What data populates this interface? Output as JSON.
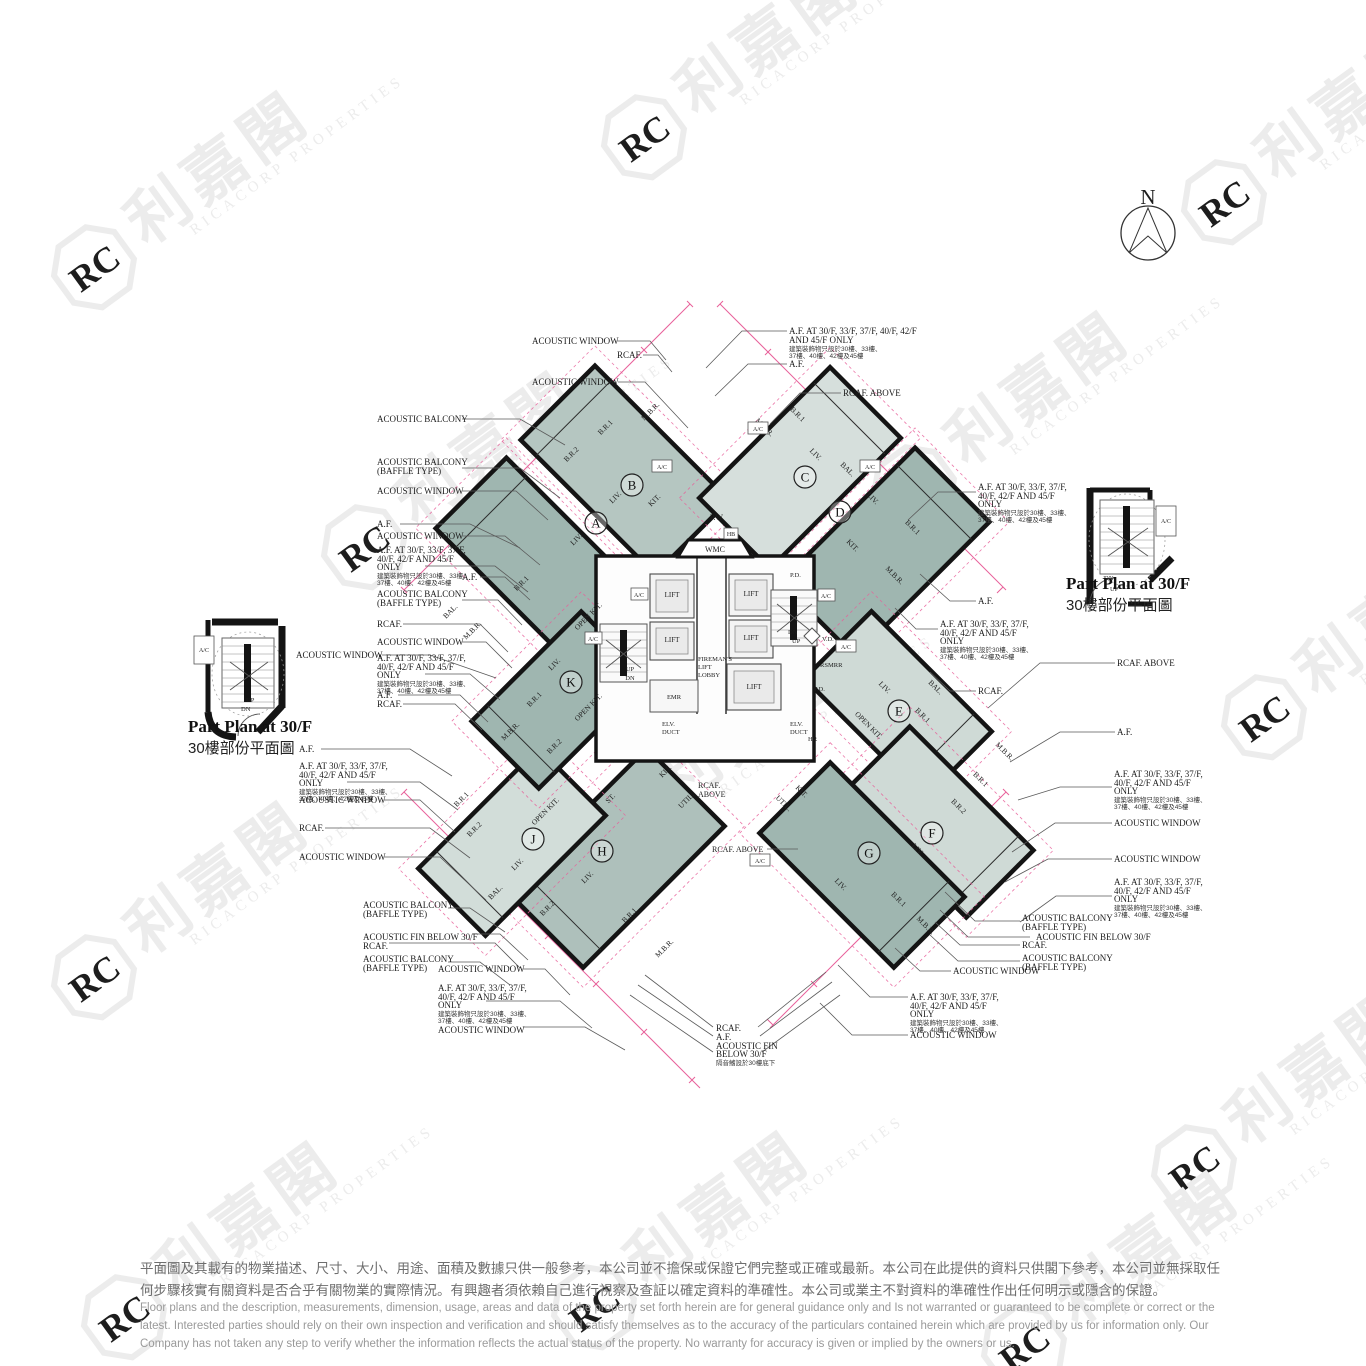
{
  "watermark": {
    "cn": "利嘉閣",
    "en": "RICACORP PROPERTIES",
    "monogram": "RC"
  },
  "north_label": "N",
  "inset": {
    "title": "Part Plan at 30/F",
    "subtitle": "30樓部份平面圖"
  },
  "labels": {
    "aw": "ACOUSTIC WINDOW",
    "ab": "ACOUSTIC BALCONY",
    "bt": "(BAFFLE TYPE)",
    "rcaf": "RCAF.",
    "rcaf_above": "RCAF. ABOVE",
    "above": "ABOVE",
    "af": "A.F.",
    "af1": "A.F. AT 30/F, 33/F, 37/F,",
    "af2": "40/F, 42/F AND 45/F",
    "af3": "ONLY",
    "afw1": "A.F. AT 30/F, 33/F, 37/F, 40/F, 42/F",
    "afw2": "AND 45/F ONLY",
    "afzh1": "建築裝飾物只設於30樓、33樓、",
    "afzh2": "37樓、40樓、42樓及45樓",
    "fin": "ACOUSTIC FIN BELOW 30/F",
    "fin1": "ACOUSTIC FIN",
    "fin2": "BELOW 30/F",
    "finzh": "隔音鰭設於30樓底下"
  },
  "core": {
    "lift": "LIFT",
    "f1": "FIREMAN'S",
    "f2": "LIFT",
    "f3": "LOBBY",
    "emr": "EMR",
    "elv1": "ELV.",
    "elv2": "DUCT",
    "vd": "V.D.",
    "rsmrr": "RSMRR",
    "pd": "P.D.",
    "hr": "HR",
    "ac": "A/C",
    "up": "UP",
    "dn": "DN",
    "pw": "P.W.",
    "wmc": "WMC",
    "hb": "HB"
  },
  "rooms": {
    "liv": "LIV.",
    "mbr": "M.B.R.",
    "br1": "B.R.1",
    "br2": "B.R.2",
    "kit": "KIT.",
    "okit": "OPEN KIT.",
    "bal": "BAL.",
    "st": "ST.",
    "util": "UTIL."
  },
  "units": {
    "a": "A",
    "b": "B",
    "c": "C",
    "d": "D",
    "e": "E",
    "f": "F",
    "g": "G",
    "h": "H",
    "j": "J",
    "k": "K"
  },
  "disclaimer": {
    "zh1": "平面圖及其載有的物業描述、尺寸、大小、用途、面積及數據只供一般參考，本公司並不擔保或保證它們完整或正確或最新。本公司在此提供的資料只供閣下參考，本公司並無採取任",
    "zh2": "何步驟核實有關資料是否合乎有關物業的實際情況。有興趣者須依賴自己進行視察及查証以確定資料的準確性。本公司或業主不對資料的準確性作出任何明示或隱含的保證。",
    "en1": "Floor plans and the description, measurements, dimension, usage, areas and data of the property set forth herein are for general guidance only and Is not warranted or guaranteed to be complete or correct or the",
    "en2": "latest. Interested parties should rely on their own inspection and verification and should satisfy themselves as to the accuracy of the particulars contained herein which are provided by us for information only.  Our",
    "en3": "Company has not taken any step to verify whether the information reflects the actual status of the property.  No warranty for accuracy is given or implied by the owners or us."
  }
}
